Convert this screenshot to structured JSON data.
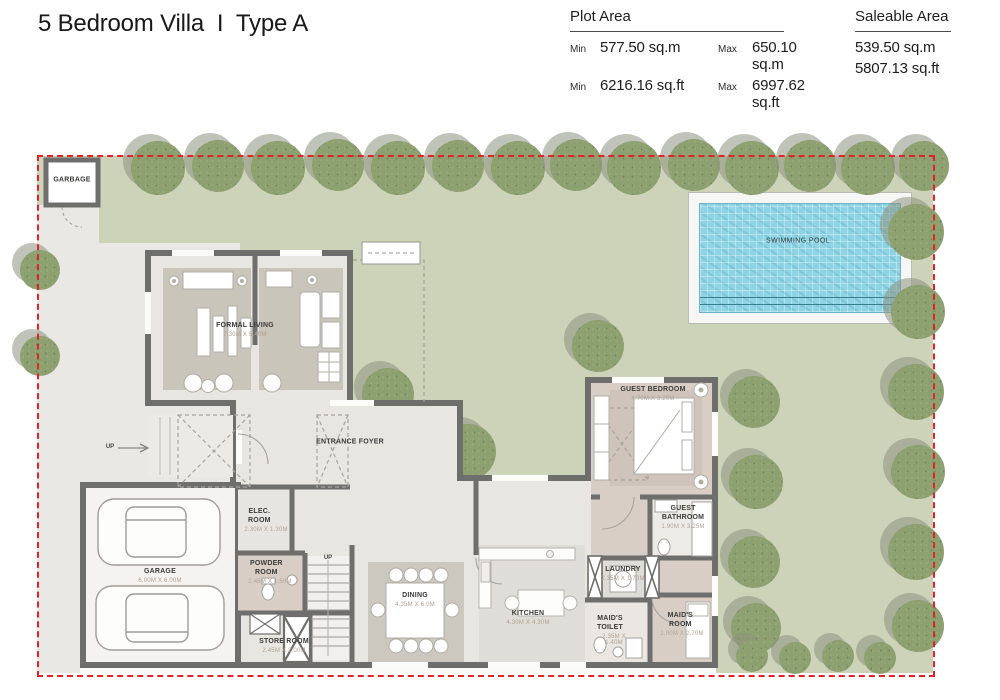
{
  "header": {
    "title": "5 Bedroom Villa  I  Type A",
    "plot_area": {
      "label": "Plot Area",
      "rows": [
        {
          "min_label": "Min",
          "min_value": "577.50 sq.m",
          "max_label": "Max",
          "max_value": "650.10 sq.m"
        },
        {
          "min_label": "Min",
          "min_value": "6216.16 sq.ft",
          "max_label": "Max",
          "max_value": "6997.62 sq.ft"
        }
      ]
    },
    "saleable_area": {
      "label": "Saleable Area",
      "values": [
        "539.50 sq.m",
        "5807.13 sq.ft"
      ]
    }
  },
  "plan": {
    "boundary_color": "#e02328",
    "lawn_color": "#cdd3b9",
    "wall_color": "#6e6e6c",
    "pool": {
      "label": "SWIMMING POOL",
      "water_color": "#8ed4e4"
    },
    "rooms": {
      "garbage": {
        "name": "GARBAGE"
      },
      "formal_living": {
        "name": "FORMAL LIVING",
        "dim": "7.30M X 5.40M"
      },
      "entrance_foyer": {
        "name": "ENTRANCE FOYER"
      },
      "garage": {
        "name": "GARAGE",
        "dim": "6.00M X 6.00M"
      },
      "elec_room": {
        "name": "ELEC. ROOM",
        "dim": "2.30M X 1.30M"
      },
      "powder_room": {
        "name": "POWDER ROOM",
        "dim": "2.45M X 1.50M"
      },
      "store_room": {
        "name": "STORE ROOM",
        "dim": "2.45M X 2.00M"
      },
      "dining": {
        "name": "DINING",
        "dim": "4.35M X 6.0M"
      },
      "kitchen": {
        "name": "KITCHEN",
        "dim": "4.30M X 4.30M"
      },
      "laundry": {
        "name": "LAUNDRY",
        "dim": "2.35M X 1.70M"
      },
      "maids_toilet": {
        "name": "MAID'S TOILET",
        "dim": "2.35M X 1.40M"
      },
      "maids_room": {
        "name": "MAID'S ROOM",
        "dim": "2.00M X 2.70M"
      },
      "guest_bedroom": {
        "name": "GUEST BEDROOM",
        "dim": "4.70M X 3.20M"
      },
      "guest_bathroom": {
        "name": "GUEST BATHROOM",
        "dim": "1.90M X 3.25M"
      },
      "up_stairs": {
        "label": "UP"
      },
      "up_entry": {
        "label": "UP"
      }
    },
    "trees": [
      {
        "x": 158,
        "y": 168,
        "r": 27
      },
      {
        "x": 218,
        "y": 166,
        "r": 26
      },
      {
        "x": 278,
        "y": 168,
        "r": 27
      },
      {
        "x": 338,
        "y": 165,
        "r": 26
      },
      {
        "x": 398,
        "y": 168,
        "r": 27
      },
      {
        "x": 458,
        "y": 166,
        "r": 26
      },
      {
        "x": 518,
        "y": 168,
        "r": 27
      },
      {
        "x": 576,
        "y": 165,
        "r": 26
      },
      {
        "x": 634,
        "y": 168,
        "r": 27
      },
      {
        "x": 694,
        "y": 165,
        "r": 26
      },
      {
        "x": 752,
        "y": 168,
        "r": 27
      },
      {
        "x": 810,
        "y": 166,
        "r": 26
      },
      {
        "x": 868,
        "y": 168,
        "r": 27
      },
      {
        "x": 924,
        "y": 166,
        "r": 25
      },
      {
        "x": 916,
        "y": 232,
        "r": 28
      },
      {
        "x": 918,
        "y": 312,
        "r": 27
      },
      {
        "x": 916,
        "y": 392,
        "r": 28
      },
      {
        "x": 918,
        "y": 472,
        "r": 27
      },
      {
        "x": 916,
        "y": 552,
        "r": 28
      },
      {
        "x": 918,
        "y": 626,
        "r": 26
      },
      {
        "x": 754,
        "y": 402,
        "r": 26
      },
      {
        "x": 756,
        "y": 482,
        "r": 27
      },
      {
        "x": 754,
        "y": 562,
        "r": 26
      },
      {
        "x": 756,
        "y": 628,
        "r": 25
      },
      {
        "x": 752,
        "y": 656,
        "r": 16
      },
      {
        "x": 795,
        "y": 658,
        "r": 16
      },
      {
        "x": 838,
        "y": 656,
        "r": 16
      },
      {
        "x": 880,
        "y": 658,
        "r": 16
      },
      {
        "x": 388,
        "y": 394,
        "r": 26
      },
      {
        "x": 468,
        "y": 452,
        "r": 28
      },
      {
        "x": 598,
        "y": 346,
        "r": 26
      },
      {
        "x": 40,
        "y": 270,
        "r": 20
      },
      {
        "x": 40,
        "y": 356,
        "r": 20
      }
    ]
  }
}
